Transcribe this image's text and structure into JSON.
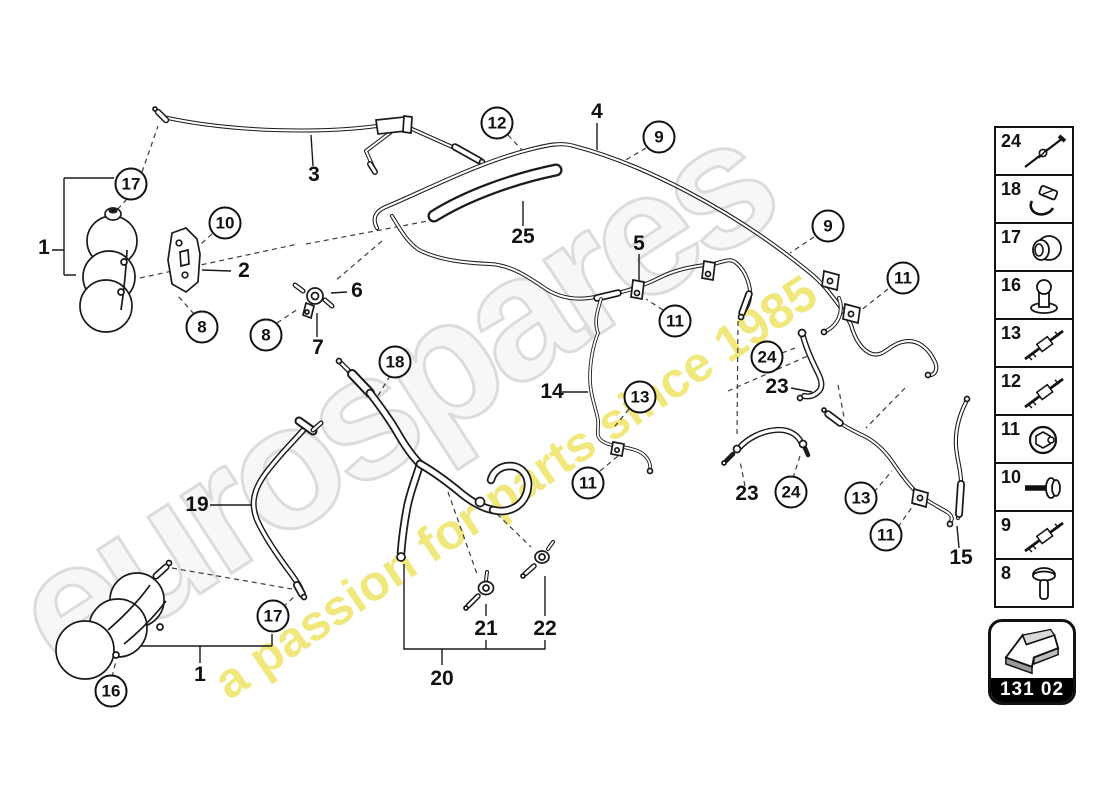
{
  "watermark": {
    "brand_text": "eurospares",
    "tagline_text": "a passion for parts since 1985",
    "brand_outline_color": "#dcdcdc",
    "tagline_color": "#f0e776"
  },
  "diagram_ref": {
    "code": "131 02",
    "icon": "direction-arrow-icon"
  },
  "legend": {
    "items": [
      {
        "number": "24",
        "icon": "cable-tie-icon"
      },
      {
        "number": "18",
        "icon": "hose-clip-icon"
      },
      {
        "number": "17",
        "icon": "grommet-icon"
      },
      {
        "number": "16",
        "icon": "rubber-mount-icon"
      },
      {
        "number": "13",
        "icon": "threaded-stud-icon"
      },
      {
        "number": "12",
        "icon": "threaded-stud-icon"
      },
      {
        "number": "11",
        "icon": "union-nut-icon"
      },
      {
        "number": "10",
        "icon": "hex-bolt-icon"
      },
      {
        "number": "9",
        "icon": "threaded-stud-icon"
      },
      {
        "number": "8",
        "icon": "pan-screw-icon"
      }
    ]
  },
  "callouts": {
    "circled": [
      {
        "label": "17",
        "x": 131,
        "y": 184
      },
      {
        "label": "10",
        "x": 225,
        "y": 223
      },
      {
        "label": "8",
        "x": 202,
        "y": 327
      },
      {
        "label": "8",
        "x": 266,
        "y": 335
      },
      {
        "label": "18",
        "x": 395,
        "y": 362
      },
      {
        "label": "12",
        "x": 497,
        "y": 123
      },
      {
        "label": "9",
        "x": 659,
        "y": 137
      },
      {
        "label": "9",
        "x": 828,
        "y": 226
      },
      {
        "label": "11",
        "x": 675,
        "y": 321
      },
      {
        "label": "11",
        "x": 903,
        "y": 278
      },
      {
        "label": "24",
        "x": 767,
        "y": 357
      },
      {
        "label": "13",
        "x": 640,
        "y": 397
      },
      {
        "label": "11",
        "x": 588,
        "y": 483
      },
      {
        "label": "24",
        "x": 791,
        "y": 492
      },
      {
        "label": "13",
        "x": 861,
        "y": 498
      },
      {
        "label": "11",
        "x": 886,
        "y": 535
      },
      {
        "label": "17",
        "x": 273,
        "y": 616
      },
      {
        "label": "16",
        "x": 111,
        "y": 691
      }
    ],
    "plain": [
      {
        "label": "1",
        "x": 44,
        "y": 248
      },
      {
        "label": "2",
        "x": 244,
        "y": 271
      },
      {
        "label": "3",
        "x": 314,
        "y": 175
      },
      {
        "label": "4",
        "x": 597,
        "y": 112
      },
      {
        "label": "5",
        "x": 639,
        "y": 244
      },
      {
        "label": "6",
        "x": 357,
        "y": 291
      },
      {
        "label": "7",
        "x": 318,
        "y": 348
      },
      {
        "label": "14",
        "x": 552,
        "y": 392
      },
      {
        "label": "15",
        "x": 961,
        "y": 558
      },
      {
        "label": "19",
        "x": 197,
        "y": 505
      },
      {
        "label": "20",
        "x": 442,
        "y": 679
      },
      {
        "label": "21",
        "x": 486,
        "y": 629
      },
      {
        "label": "22",
        "x": 545,
        "y": 629
      },
      {
        "label": "23",
        "x": 777,
        "y": 387
      },
      {
        "label": "23",
        "x": 747,
        "y": 494
      },
      {
        "label": "25",
        "x": 523,
        "y": 237
      },
      {
        "label": "1",
        "x": 200,
        "y": 675
      }
    ]
  }
}
